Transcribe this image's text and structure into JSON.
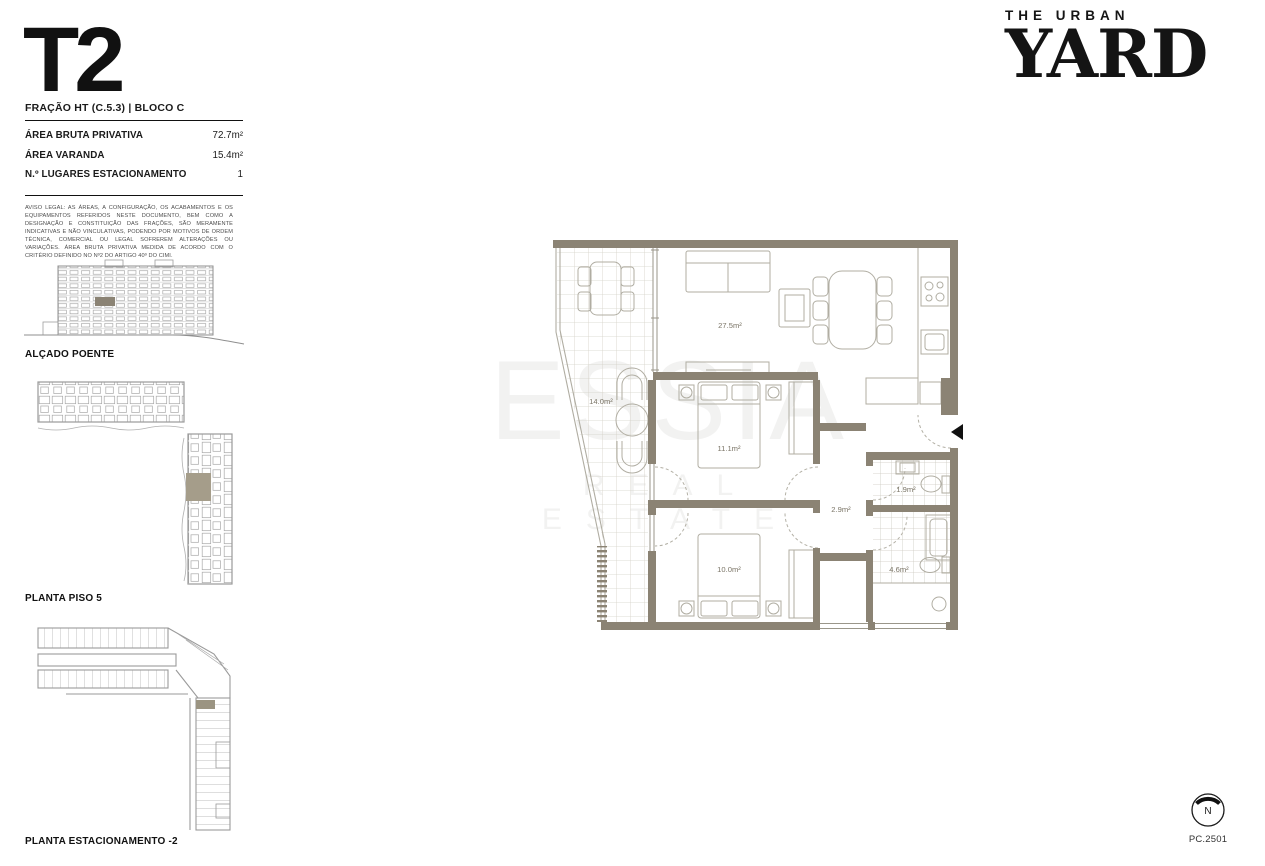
{
  "document": {
    "unit_type": "T2",
    "fraction": "FRAÇÃO HT (C.5.3) | BLOCO C",
    "drawing_code": "PC.2501"
  },
  "brand": {
    "line1": "THE URBAN",
    "line2": "YARD"
  },
  "area_table": {
    "rows": [
      {
        "label": "ÁREA BRUTA PRIVATIVA",
        "value": "72.7m²"
      },
      {
        "label": "ÁREA VARANDA",
        "value": "15.4m²"
      },
      {
        "label": "N.º LUGARES ESTACIONAMENTO",
        "value": "1"
      }
    ]
  },
  "legal_notice": "AVISO LEGAL: AS ÁREAS, A CONFIGURAÇÃO, OS ACABAMENTOS E OS EQUIPAMENTOS REFERIDOS NESTE DOCUMENTO, BEM COMO A DESIGNAÇÃO E CONSTITUIÇÃO DAS FRAÇÕES, SÃO MERAMENTE INDICATIVAS E NÃO VINCULATIVAS, PODENDO POR MOTIVOS DE ORDEM TÉCNICA, COMERCIAL OU LEGAL SOFREREM ALTERAÇÕES OU VARIAÇÕES. ÁREA BRUTA PRIVATIVA MEDIDA DE ACORDO COM O CRITÉRIO DEFINIDO NO Nº2 DO ARTIGO 40º DO CIMI.",
  "key_plans": {
    "elevation_label": "ALÇADO POENTE",
    "floor_plan_label": "PLANTA PISO 5",
    "parking_label": "PLANTA ESTACIONAMENTO -2"
  },
  "compass": {
    "label": "N"
  },
  "watermark": {
    "line1": "ESSIA",
    "line2": "REAL ESTATE"
  },
  "floor_plan": {
    "rooms": [
      {
        "name": "living-dining",
        "area": "27.5m²"
      },
      {
        "name": "balcony",
        "area": "14.0m²"
      },
      {
        "name": "bedroom-1",
        "area": "11.1m²"
      },
      {
        "name": "hallway",
        "area": "2.9m²"
      },
      {
        "name": "wc",
        "area": "1.9m²"
      },
      {
        "name": "bedroom-2",
        "area": "10.0m²"
      },
      {
        "name": "bathroom",
        "area": "4.6m²"
      }
    ]
  },
  "colors": {
    "wall": "#8b8374",
    "line": "#b0ada2",
    "room_text": "#7b7567",
    "ink": "#1a1a1a"
  }
}
